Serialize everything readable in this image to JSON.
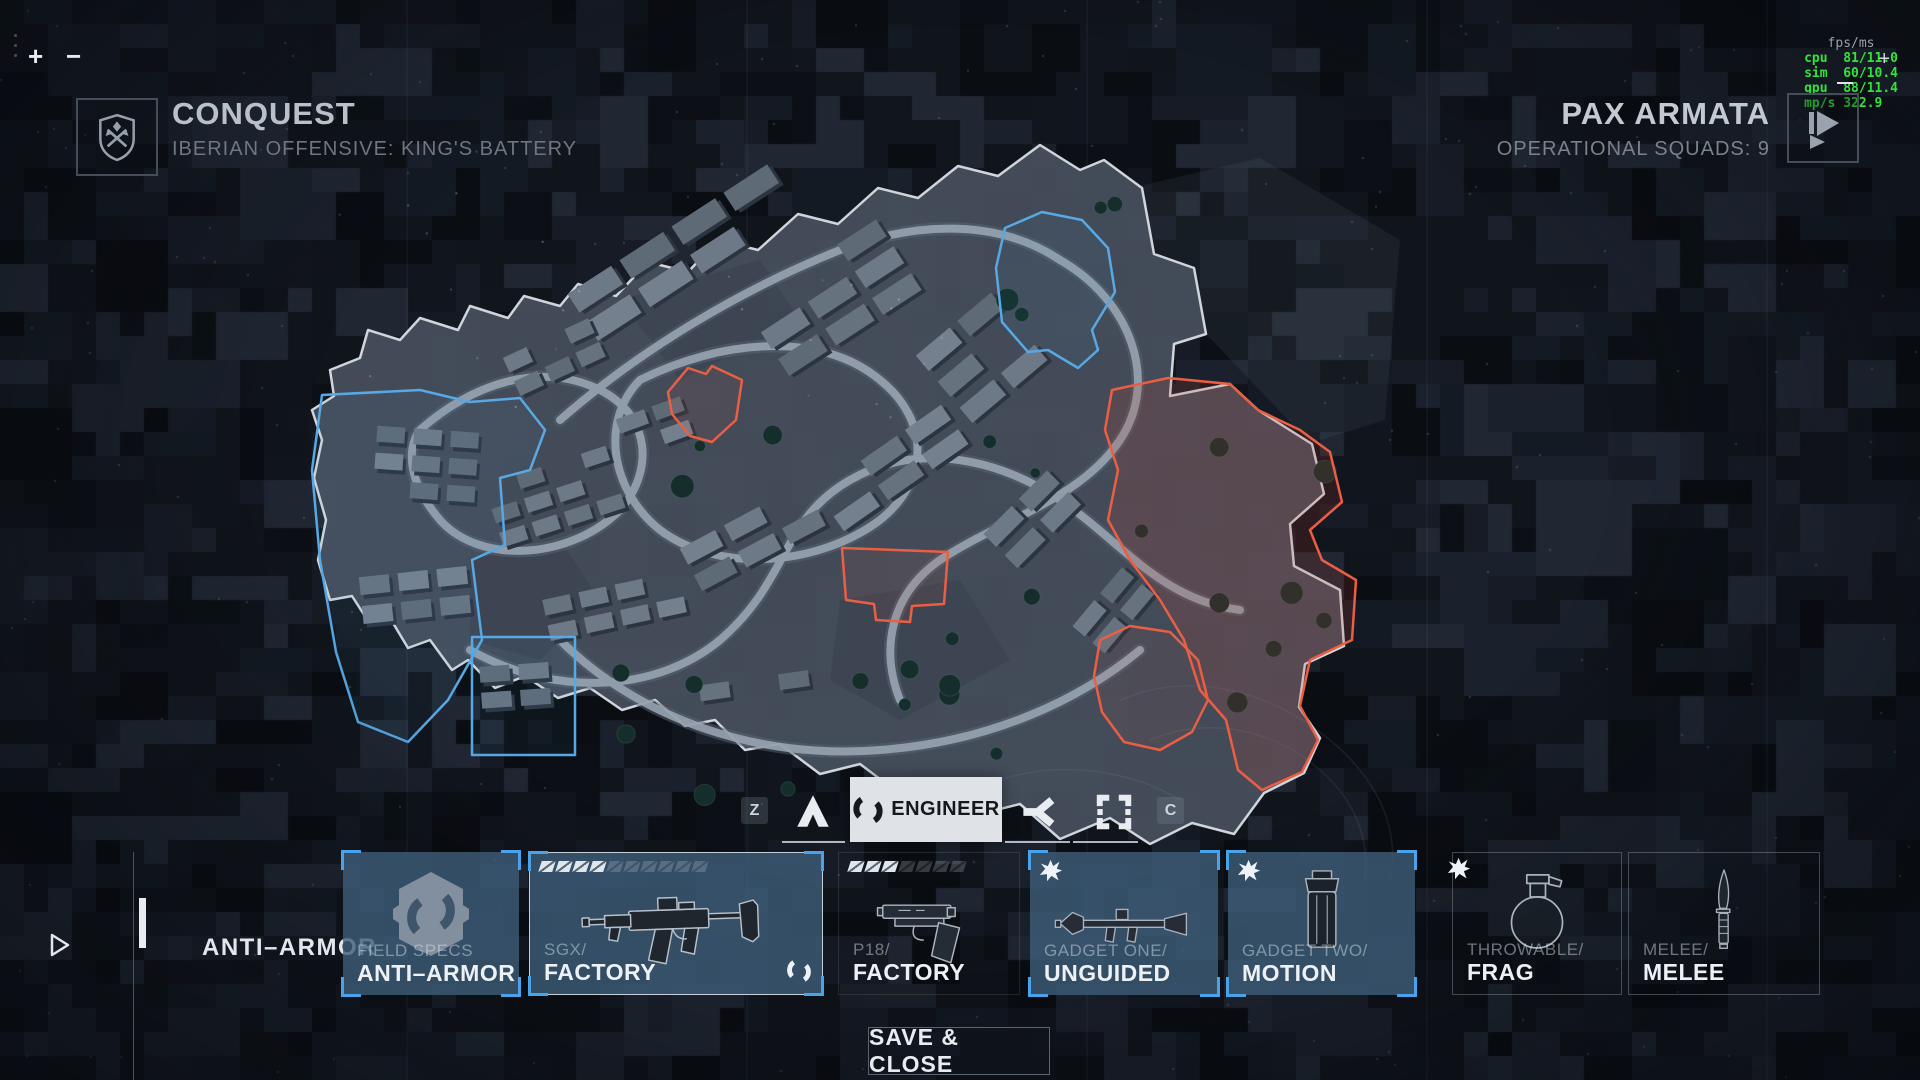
{
  "hud": {
    "zoom_in": "+",
    "zoom_out": "−",
    "cursor": "+",
    "fps_panel": {
      "title": "fps/ms",
      "accent_color": "#35e23c",
      "rows": [
        {
          "label": "cpu",
          "value": "81/11.0"
        },
        {
          "label": "sim",
          "value": "60/10.4"
        },
        {
          "label": "gpu",
          "value": "88/11.4"
        },
        {
          "label": "mp/s",
          "value": "322.9"
        }
      ]
    }
  },
  "header": {
    "left": {
      "icon": "conquest-shield",
      "mode": "CONQUEST",
      "mission": "IBERIAN OFFENSIVE: KING'S BATTERY"
    },
    "right": {
      "icon": "pax-armata-logo",
      "faction": "PAX ARMATA",
      "squads": "OPERATIONAL SQUADS: 9"
    }
  },
  "class_bar": {
    "prev_key": "Z",
    "next_key": "C",
    "classes": [
      {
        "name": "assault",
        "icon": "assault-icon",
        "selected": false
      },
      {
        "name": "engineer",
        "icon": "engineer-icon",
        "selected": true,
        "label": "ENGINEER"
      },
      {
        "name": "support",
        "icon": "support-icon",
        "selected": false
      },
      {
        "name": "recon",
        "icon": "recon-icon",
        "selected": false
      }
    ]
  },
  "loadout": {
    "row_label": "ANTI–ARMOR",
    "cards": [
      {
        "category": "FIELD SPECS",
        "name": "ANTI–ARMOR",
        "icon": "anti-armor-hex",
        "style": "blue-selected"
      },
      {
        "category": "SGX/",
        "name": "FACTORY",
        "icon": "smg",
        "style": "blue-selected-highlight",
        "ammo_filled": 4,
        "ammo_total": 10,
        "class_glyph": "engineer-icon"
      },
      {
        "category": "P18/",
        "name": "FACTORY",
        "icon": "pistol",
        "style": "plain",
        "ammo_filled": 3,
        "ammo_total": 7
      },
      {
        "category": "GADGET ONE/",
        "name": "UNGUIDED",
        "icon": "rpg",
        "style": "blue-selected",
        "explosive_badge": true
      },
      {
        "category": "GADGET TWO/",
        "name": "MOTION",
        "icon": "motion-sensor",
        "style": "blue-selected",
        "explosive_badge": true
      },
      {
        "category": "THROWABLE/",
        "name": "FRAG",
        "icon": "frag-grenade",
        "style": "plain-bordered",
        "explosive_badge": true
      },
      {
        "category": "MELEE/",
        "name": "MELEE",
        "icon": "knife",
        "style": "plain-bordered"
      }
    ]
  },
  "footer": {
    "save_label": "SAVE & CLOSE"
  },
  "map": {
    "colors": {
      "friendly_zone": "#57a8e4",
      "enemy_zone": "#ea5f44",
      "boundary": "#cfd5db",
      "road": "#98a4b1",
      "ground": "#47505e"
    }
  }
}
